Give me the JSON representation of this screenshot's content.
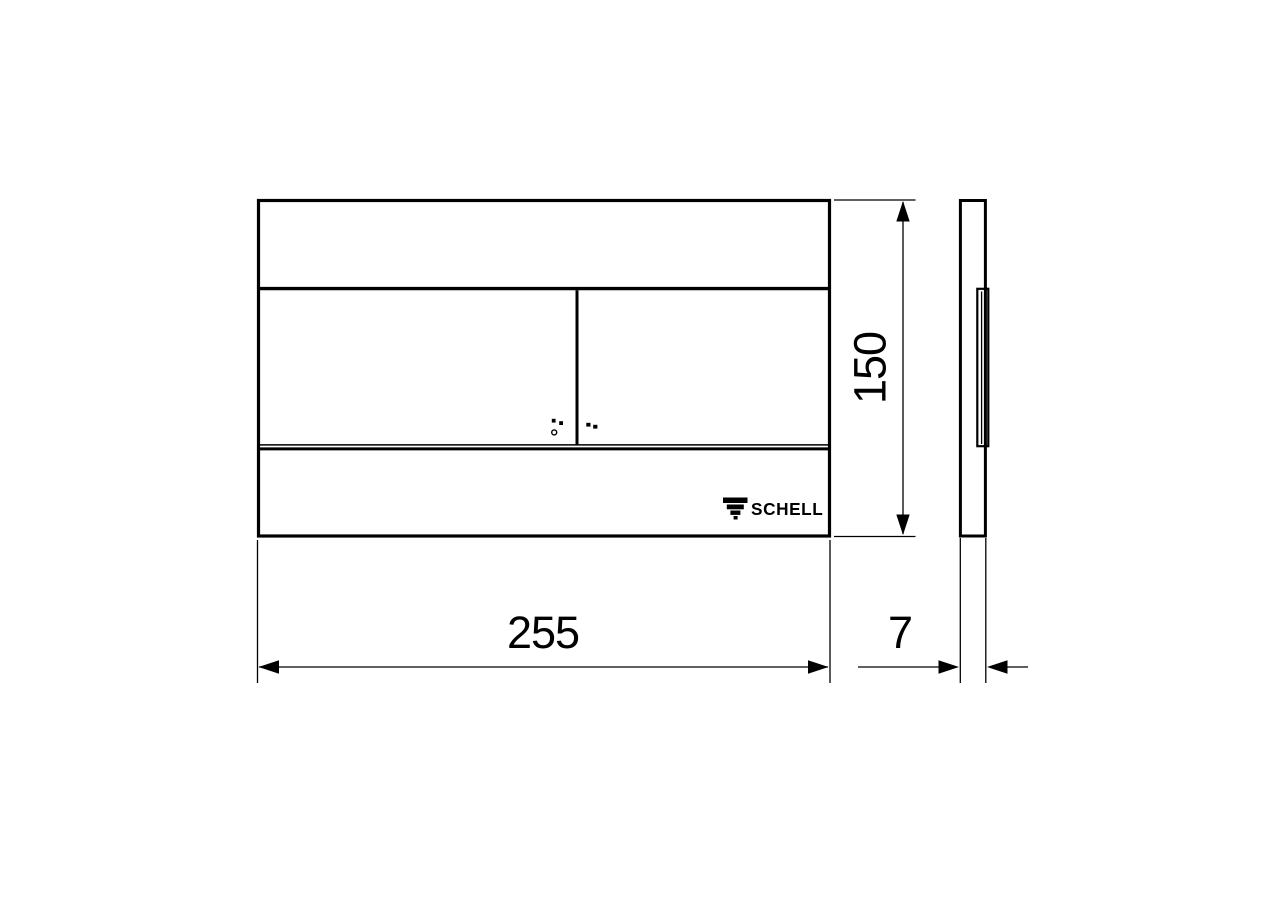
{
  "brand": {
    "name": "SCHELL"
  },
  "dimensions": {
    "width_mm": "255",
    "height_mm": "150",
    "depth_mm": "7"
  },
  "icons": {
    "schell_logo": "stepped-inverted-triangle",
    "tactile_large_flush": "two-dots-and-ring",
    "tactile_small_flush": "two-dots"
  },
  "colors": {
    "line": "#000000",
    "background": "#ffffff"
  }
}
